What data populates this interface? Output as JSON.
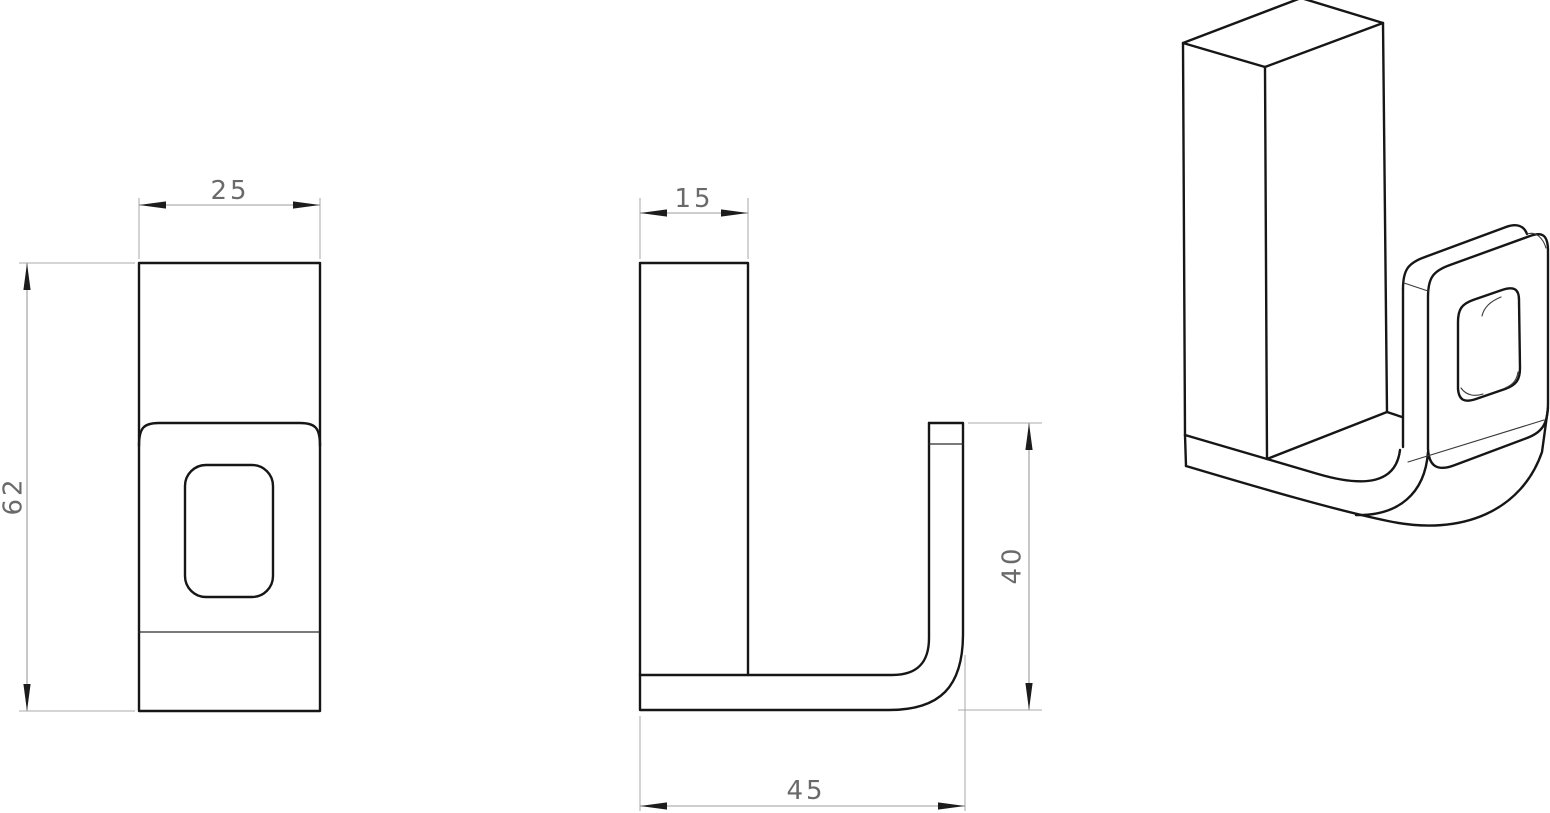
{
  "drawing": {
    "type": "technical-drawing",
    "part": "j-hook-bracket-three-view-drawing",
    "background": "#ffffff",
    "outline_color": "#161616",
    "dimension_line_color": "#9c9c9c",
    "extension_line_color": "#ababab",
    "arrow_color": "#1c1c1c",
    "dimension_text_color": "#6a6a6a",
    "views": [
      {
        "id": "front-view",
        "dimensions": [
          {
            "name": "width",
            "value": "25",
            "orientation": "horizontal"
          },
          {
            "name": "height",
            "value": "62",
            "orientation": "vertical"
          }
        ]
      },
      {
        "id": "side-view",
        "dimensions": [
          {
            "name": "thickness",
            "value": "15",
            "orientation": "horizontal"
          },
          {
            "name": "hook_height",
            "value": "40",
            "orientation": "vertical"
          },
          {
            "name": "depth",
            "value": "45",
            "orientation": "horizontal"
          }
        ]
      },
      {
        "id": "isometric-view",
        "dimensions": []
      }
    ]
  }
}
